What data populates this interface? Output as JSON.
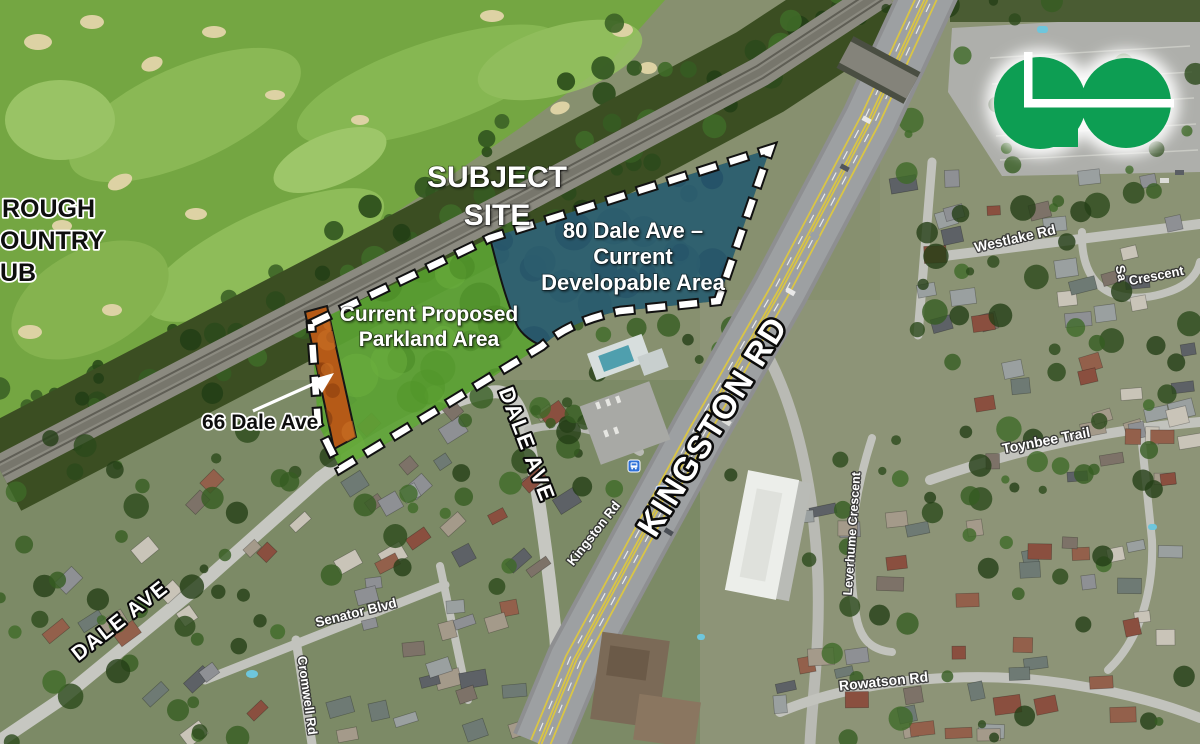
{
  "annotations": {
    "subject_site": [
      "SUBJECT",
      "SITE"
    ],
    "developable_area": [
      "80 Dale Ave –",
      "Current",
      "Developable Area"
    ],
    "parkland_area": [
      "Current Proposed",
      "Parkland Area"
    ],
    "address_66": "66 Dale Ave",
    "golf_club_fragments": [
      "ROUGH",
      "OUNTRY",
      "UB"
    ]
  },
  "road_labels": {
    "kingston_rd_major": "KINGSTON RD",
    "kingston_rd_minor": "Kingston Rd",
    "dale_ave_upper": "DALE AVE",
    "dale_ave_lower": "DALE AVE",
    "westlake_rd": "Westlake Rd",
    "crescent_prefix": "Sa",
    "crescent": "Crescent",
    "toynbee_trail": "Toynbee Trail",
    "leverhume_crescent": "Leverhume Crescent",
    "senator_blvd": "Senator Blvd",
    "cromwell_rd": "Cromwell Rd",
    "rowatson_rd": "Rowatson Rd"
  },
  "logo": {
    "name": "GO Transit",
    "green": "#0d9e53"
  },
  "overlay_colors": {
    "developable_blue": "#2e6ba8",
    "parkland_green": "#5ba233",
    "parcel_66_orange": "#b55a17",
    "boundary_dash_white": "#ffffff"
  },
  "transit_stops": {
    "count": 2,
    "color": "#2f71d8"
  }
}
